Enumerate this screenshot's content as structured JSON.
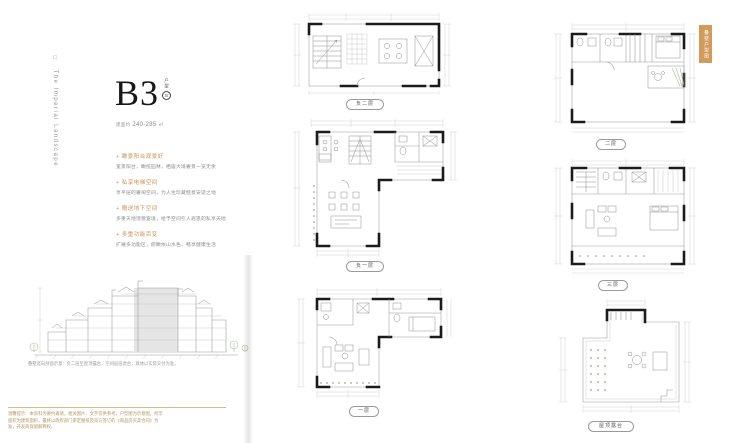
{
  "page": {
    "background": "#ffffff",
    "accent": "#cf9a5c"
  },
  "brand": {
    "logo_square": "□",
    "vertical_text": "The Imperial Landscape"
  },
  "unit": {
    "code": "B3",
    "type_vertical": "户型",
    "class_badge": "S",
    "area_prefix": "建面约",
    "area_value": "240-285",
    "area_unit": "㎡"
  },
  "features": [
    {
      "heading": "瞰景阳台观景好",
      "body": "宽景阳台，瞰揽园林，栖居大境奢景一览无余"
    },
    {
      "heading": "私享电梯空间",
      "body": "享平层的奢阔空间，为人生珍藏惬意安适之地"
    },
    {
      "heading": "赠送地下空间",
      "body": "多重天地馈赠宽境，给予空间引人遐思的私享天地"
    },
    {
      "heading": "多重功能百变",
      "body": "扩展多功能区，俯瞰依山水色，畅享健康生活"
    }
  ],
  "section": {
    "caption": "叠墅竖向剖面示意：负二层至屋顶露台，空间层层退台，具体以实际交付为准。"
  },
  "plans": [
    {
      "id": "b2",
      "label": "负二层"
    },
    {
      "id": "b1",
      "label": "负一层"
    },
    {
      "id": "f1",
      "label": "一层"
    },
    {
      "id": "f2",
      "label": "二层"
    },
    {
      "id": "f3",
      "label": "三层"
    },
    {
      "id": "roof",
      "label": "屋顶露台"
    }
  ],
  "ribbon": {
    "label": "叠墅户型图"
  },
  "disclaimer": {
    "line": "温馨提示：本资料为要约邀请，相关图片、文字仅供参考，户型图为示意图，所示面积为建筑面积，最终以政府部门审定图纸及双方签订的《商品房买卖合同》为准，开发商保留解释权。"
  }
}
